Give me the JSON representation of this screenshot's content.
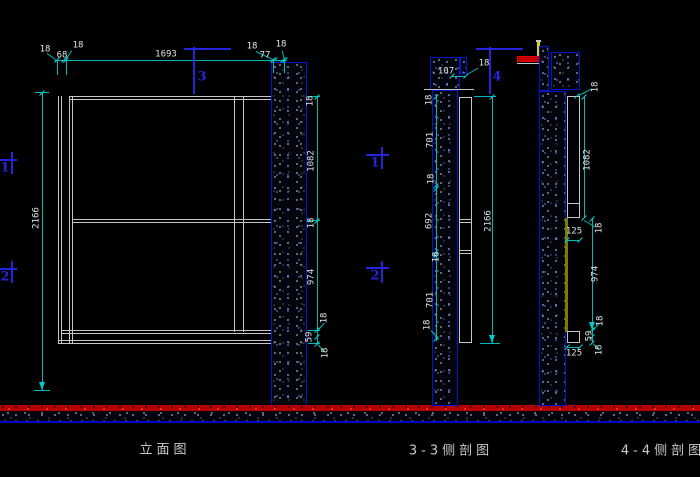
{
  "captions": {
    "elevation": "立面图",
    "section_33": "3-3侧剖图",
    "section_44": "4-4侧剖图"
  },
  "markers": {
    "cut3": "3",
    "cut4": "4",
    "mid1": "1",
    "mid2": "2",
    "edge1": "1",
    "edge2": "2"
  },
  "elevation": {
    "top_dims": [
      "18",
      "68",
      "18",
      "1693",
      "18",
      "77",
      "18"
    ],
    "height": "2166",
    "right_dims": [
      "18",
      "1082",
      "18",
      "974"
    ],
    "bottom_dims": [
      "18",
      "59",
      "18"
    ]
  },
  "section33": {
    "top_width": "107",
    "top_thickness": "18",
    "left_dims": [
      "18",
      "701",
      "18",
      "692",
      "18",
      "701"
    ],
    "bottom_thickness": "18",
    "height": "2166"
  },
  "section44": {
    "top_thickness": "18",
    "upper_height": "1082",
    "ledge_width": "125",
    "ledge_thickness": "18",
    "lower_height": "974",
    "bottom_dims": [
      "18",
      "59",
      "18"
    ],
    "bottom_width": "125"
  },
  "colors": {
    "background": "#000000",
    "dimension_line": "#00b8b8",
    "dimension_text": "#e0e4e4",
    "structure_line": "#c6c6c6",
    "hatch_outline": "#0016d6",
    "marker_blue": "#2424dc",
    "floor_red": "#b40000",
    "floor_blue": "#0000cd",
    "beam_red": "#c40000",
    "bar_yellow": "#d6d600",
    "strip_olive": "#7c7c00"
  }
}
